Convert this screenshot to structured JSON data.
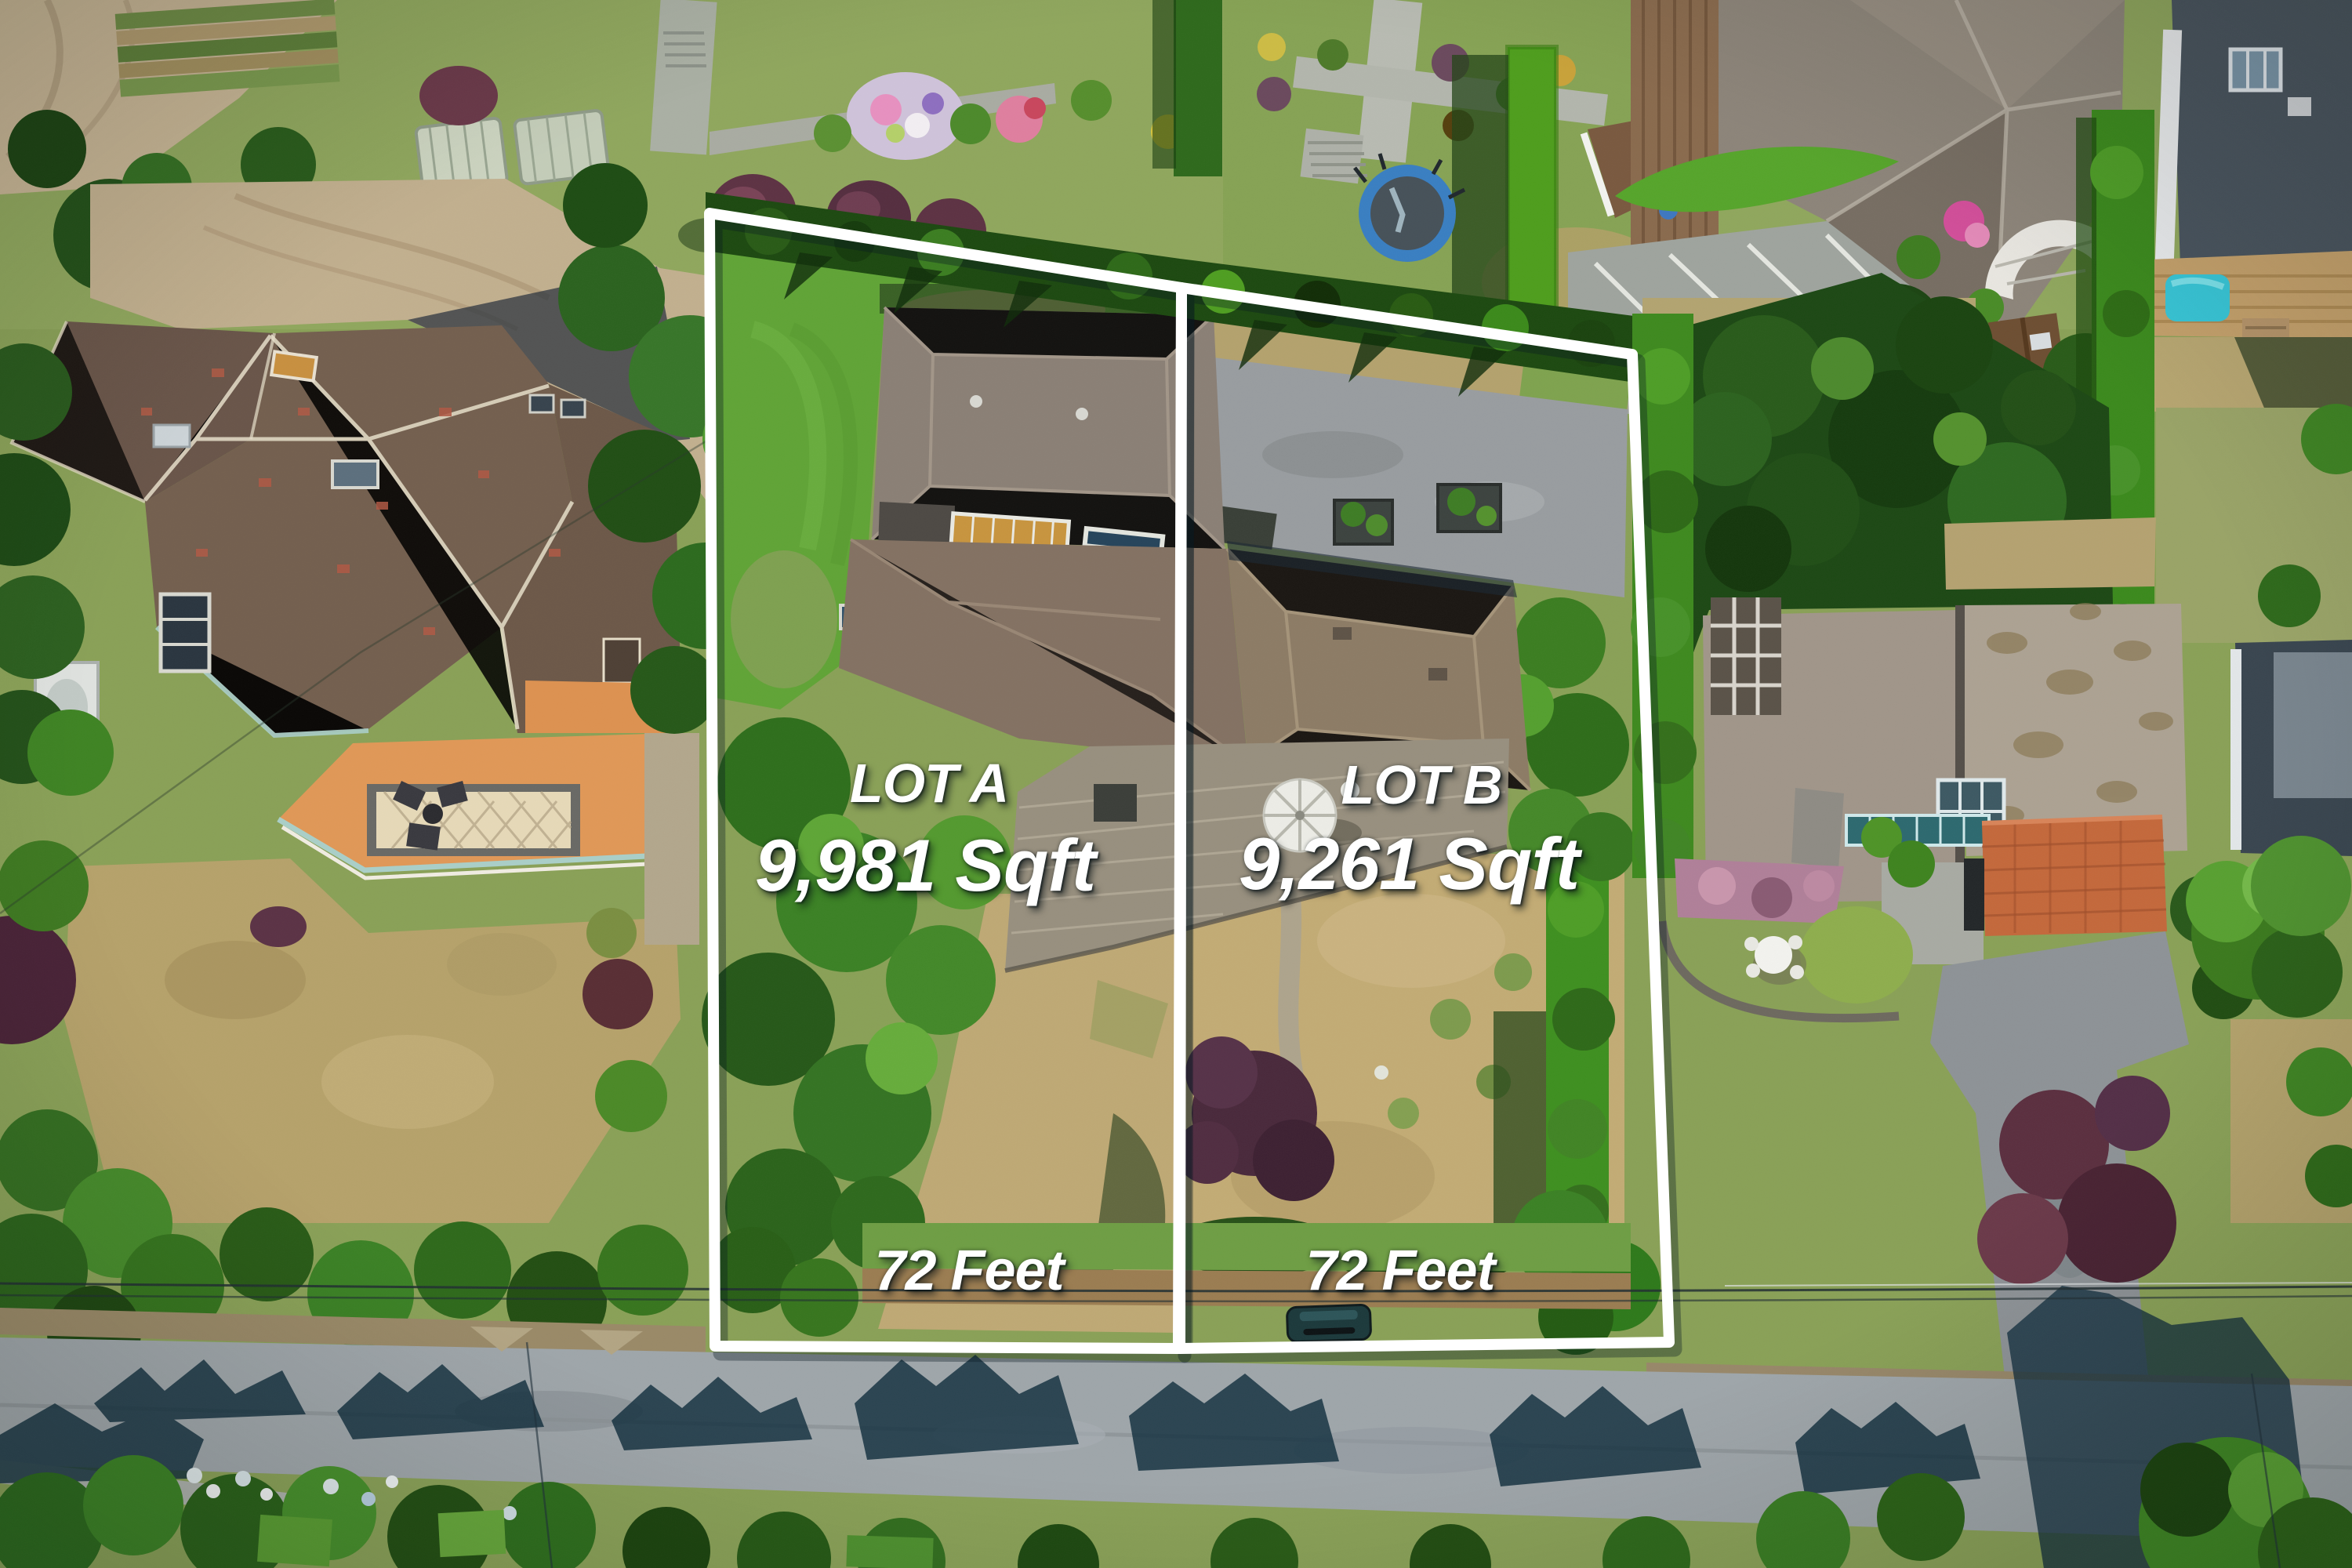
{
  "annotations": {
    "lot_a": {
      "label": "LOT A",
      "area": "9,981 Sqft",
      "frontage": "72 Feet"
    },
    "lot_b": {
      "label": "LOT B",
      "area": "9,261 Sqft",
      "frontage": "72 Feet"
    },
    "boundary_color": "#ffffff",
    "label_text_color": "#ffffff"
  }
}
